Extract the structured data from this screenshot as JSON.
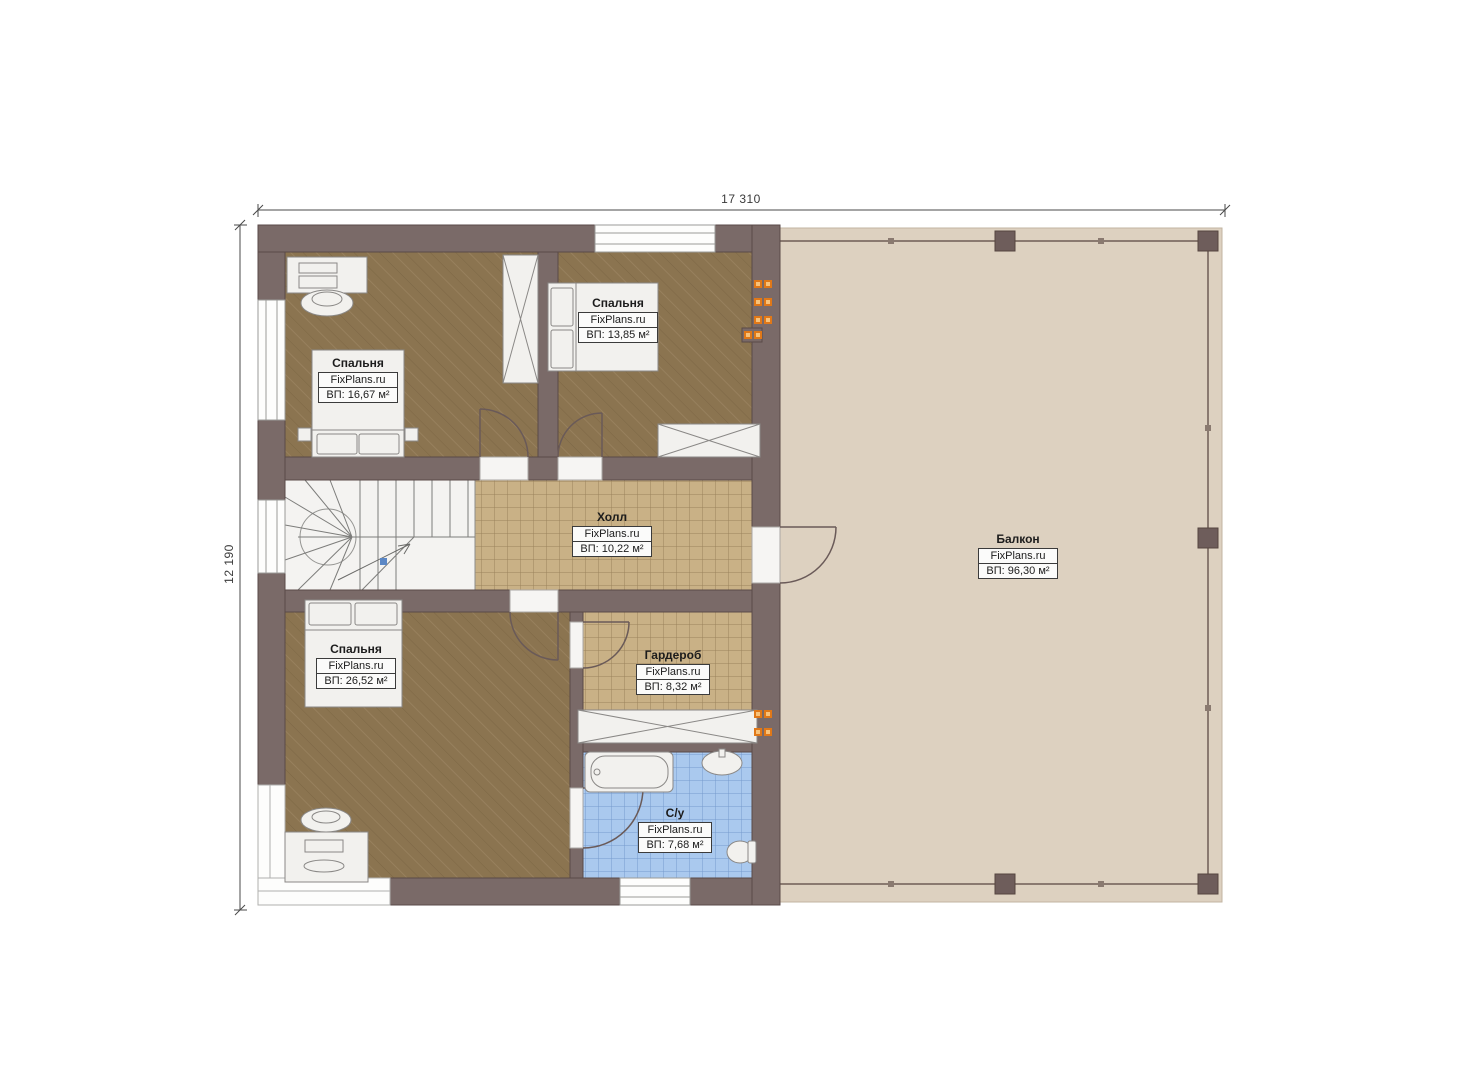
{
  "dimensions": {
    "top": "17 310",
    "left": "12 190"
  },
  "rooms": {
    "bedroom_tl": {
      "name": "Спальня",
      "brand": "FixPlans.ru",
      "area": "ВП: 16,67 м²"
    },
    "bedroom_tm": {
      "name": "Спальня",
      "brand": "FixPlans.ru",
      "area": "ВП: 13,85 м²"
    },
    "hall": {
      "name": "Холл",
      "brand": "FixPlans.ru",
      "area": "ВП: 10,22 м²"
    },
    "bedroom_b": {
      "name": "Спальня",
      "brand": "FixPlans.ru",
      "area": "ВП: 26,52 м²"
    },
    "wardrobe": {
      "name": "Гардероб",
      "brand": "FixPlans.ru",
      "area": "ВП: 8,32 м²"
    },
    "bathroom": {
      "name": "С/у",
      "brand": "FixPlans.ru",
      "area": "ВП: 7,68 м²"
    },
    "balcony": {
      "name": "Балкон",
      "brand": "FixPlans.ru",
      "area": "ВП: 96,30 м²"
    }
  },
  "colors": {
    "wall": "#7a6a68",
    "wall_edge": "#5a4a48",
    "bedroom_floor": "#8b7450",
    "tile_floor": "#c9b186",
    "bathroom_floor": "#aac9ee",
    "balcony_floor": "#ddd1c0",
    "accent_orange": "#e07818",
    "accent_orange_light": "#f8c27a",
    "stairs_bg": "#f4f3f1",
    "dimension_line": "#4a4a4a"
  }
}
